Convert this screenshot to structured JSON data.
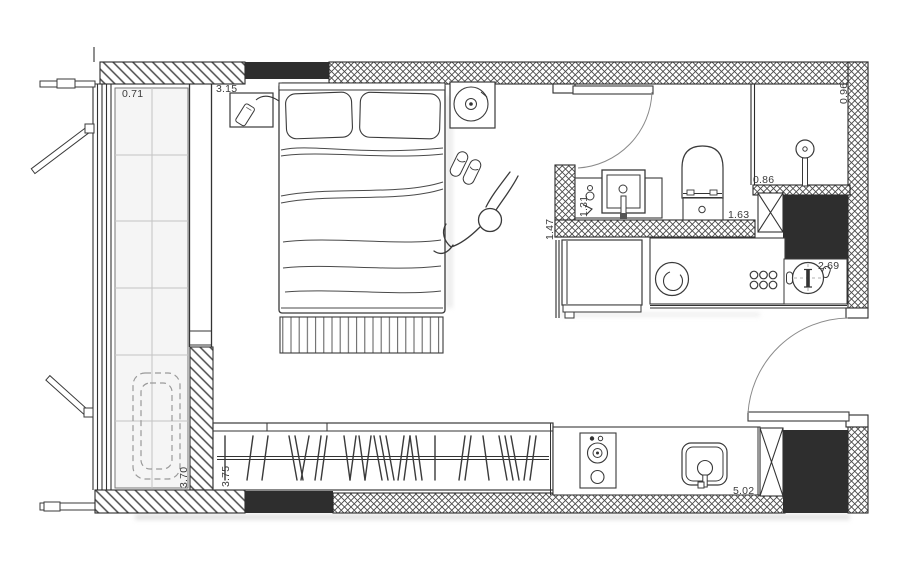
{
  "dimensions": {
    "balcony_width": "0.71",
    "bedroom_width": "3.15",
    "shower_width": "0.96",
    "shower_depth": "0.86",
    "wc_width": "1.63",
    "wc_depth": "1.47",
    "vanity_width": "1.31",
    "dining_width": "2.69",
    "balcony_length": "3.70",
    "wardrobe_length": "3.75",
    "kitchen_length": "5.02"
  },
  "colors": {
    "background": "#ffffff",
    "wall_fill": "#2e2e2e",
    "line": "#333333",
    "dimension_text": "#3a3a3a",
    "glass_tint": "#f5f5f5"
  },
  "symbols": [
    "bed",
    "pillows",
    "bed-runner",
    "bedside-table",
    "phone",
    "record-player",
    "slippers",
    "person",
    "wardrobe-hangers",
    "balcony-glazing",
    "folding-rack",
    "window-casements",
    "washing-machine",
    "fridge",
    "dining-table",
    "hob-knobs",
    "cooktop",
    "kitchen-sink",
    "bathroom-vanity",
    "towel-hook",
    "toilet",
    "shower-head",
    "entry-door",
    "bathroom-door",
    "duct-shaft"
  ]
}
